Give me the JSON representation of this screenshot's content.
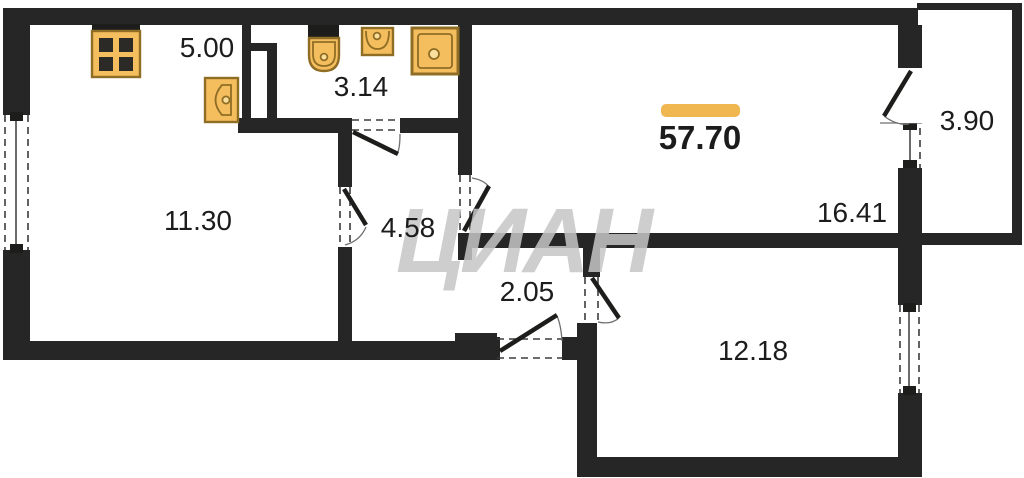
{
  "total_area": "57.70",
  "rooms": [
    {
      "name": "kitchen",
      "area": "5.00"
    },
    {
      "name": "bathroom",
      "area": "3.14"
    },
    {
      "name": "living-room",
      "area": "11.30"
    },
    {
      "name": "hallway",
      "area": "4.58"
    },
    {
      "name": "corridor",
      "area": "2.05"
    },
    {
      "name": "main-room",
      "area": "16.41"
    },
    {
      "name": "balcony",
      "area": "3.90"
    },
    {
      "name": "bedroom",
      "area": "12.18"
    }
  ],
  "watermark": {
    "text": "ЦИАН"
  },
  "icons": [
    "stove-icon",
    "kitchen-sink-icon",
    "toilet-icon",
    "washbasin-icon",
    "washing-machine-icon"
  ],
  "colors": {
    "wall": "#262626",
    "fixture_fill": "#F4BE5E",
    "fixture_stroke": "#8F6D25",
    "accent_bar": "#F0B64F",
    "watermark": "#C6C6C6",
    "label": "#1C1C1C"
  }
}
